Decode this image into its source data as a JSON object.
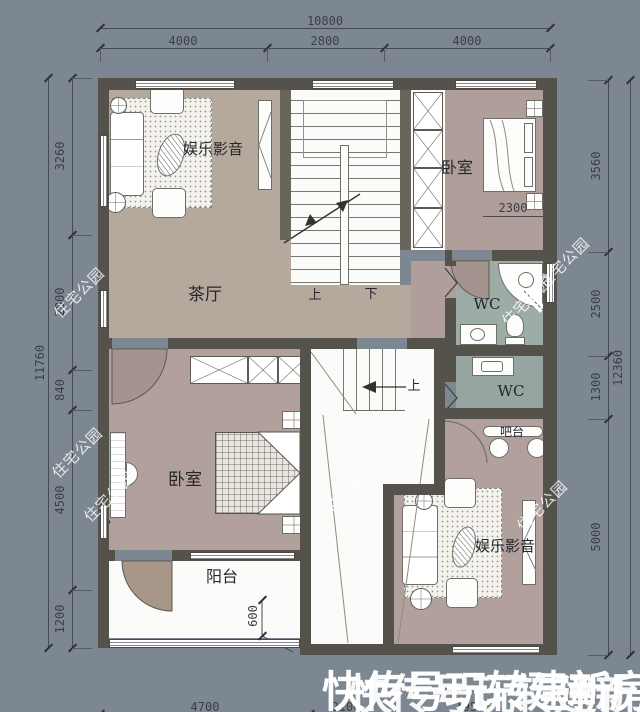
{
  "plan": {
    "room_labels": {
      "media_top": "娱乐影音",
      "bedroom_top": "卧室",
      "tea_hall": "茶厅",
      "wc_upper": "WC",
      "wc_lower": "WC",
      "bar": "吧台",
      "bedroom_bottom": "卧室",
      "media_bottom": "娱乐影音",
      "balcony": "阳台",
      "stair_up_label": "上",
      "stair_down_label": "下",
      "stair_up2_label": "上"
    },
    "dimensions": {
      "top": {
        "total": "10800",
        "segments": [
          "4000",
          "2800",
          "4000"
        ]
      },
      "left": {
        "total": "11760",
        "segments": [
          "3260",
          "2800",
          "840",
          "4500",
          "1200"
        ]
      },
      "right": {
        "total": "12360",
        "segments": [
          "3560",
          "2500",
          "1300",
          "5000"
        ]
      },
      "bottom_partial": [
        "4700",
        "2100",
        "1950"
      ],
      "bed_width": "2300",
      "balcony_step": "600"
    },
    "watermark_text": "住宅公园",
    "overlay_text_1": "快传号玩转建新房",
    "overlay_text_2": "快传号玩转建新房"
  },
  "colors": {
    "background": "#7d8791",
    "wall": "#54524b",
    "floor_tan": "#b5a89c",
    "floor_mauve": "#b09e9a",
    "floor_teal": "#9dada6",
    "watermark": "#ffffff",
    "dim_text": "#3b4047"
  }
}
